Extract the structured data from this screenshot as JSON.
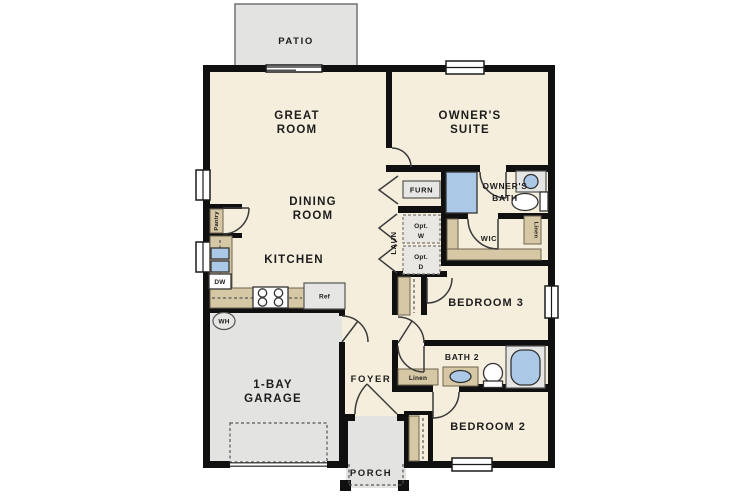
{
  "colors": {
    "wall": "#101010",
    "floor": "#f5eedd",
    "concrete": "#e3e3e2",
    "counter_tan": "#d6c7a5",
    "fixture_blue": "#abc9e6",
    "background": "#ffffff"
  },
  "labels": {
    "patio": "PATIO",
    "great_room_line1": "GREAT",
    "great_room_line2": "ROOM",
    "owners_suite_line1": "OWNER'S",
    "owners_suite_line2": "SUITE",
    "dining_line1": "DINING",
    "dining_line2": "ROOM",
    "kitchen": "KITCHEN",
    "pantry": "Pantry",
    "laundry": "LAUN",
    "opt_w_line1": "Opt.",
    "opt_w_line2": "W",
    "opt_d_line1": "Opt.",
    "opt_d_line2": "D",
    "furnace": "FURN",
    "owners_bath_line1": "OWNER'S",
    "owners_bath_line2": "BATH",
    "wic": "WIC",
    "linen_wic": "Linen",
    "bedroom3": "BEDROOM 3",
    "bath2": "BATH 2",
    "linen_bath2": "Linen",
    "bedroom2": "BEDROOM 2",
    "garage_line1": "1-BAY",
    "garage_line2": "GARAGE",
    "foyer": "FOYER",
    "porch": "PORCH",
    "dishwasher": "DW",
    "refrigerator": "Ref",
    "water_heater": "WH"
  }
}
